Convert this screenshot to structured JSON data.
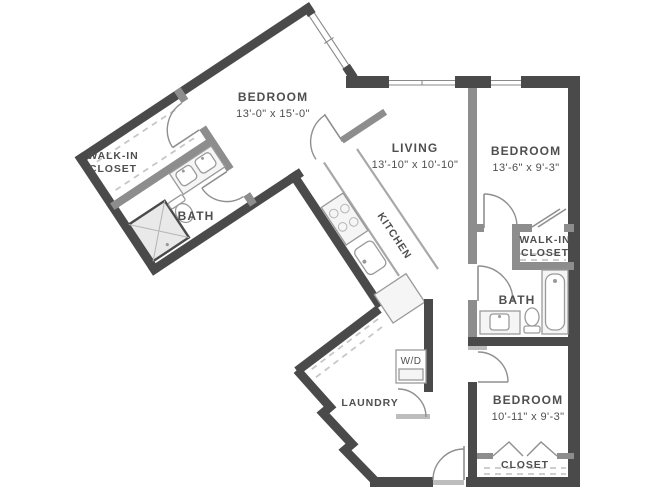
{
  "plan": {
    "rooms": {
      "bedroom1": {
        "name": "BEDROOM",
        "dims": "13'-0\" x 15'-0\""
      },
      "living": {
        "name": "LIVING",
        "dims": "13'-10\" x 10'-10\""
      },
      "bedroom2": {
        "name": "BEDROOM",
        "dims": "13'-6\" x 9'-3\""
      },
      "bedroom3": {
        "name": "BEDROOM",
        "dims": "10'-11\" x 9'-3\""
      },
      "kitchen": {
        "name": "KITCHEN"
      },
      "bath1": {
        "name": "BATH"
      },
      "bath2": {
        "name": "BATH"
      },
      "wic1": {
        "line1": "WALK-IN",
        "line2": "CLOSET"
      },
      "wic2": {
        "line1": "WALK-IN",
        "line2": "CLOSET"
      },
      "laundry": {
        "name": "LAUNDRY"
      },
      "closet3": {
        "name": "CLOSET"
      },
      "wd": {
        "name": "W/D"
      }
    },
    "fixtures": [
      "shower",
      "toilet",
      "double-vanity-sinks",
      "kitchen-stove",
      "kitchen-sink",
      "refrigerator",
      "washer-dryer",
      "bathtub",
      "vanity-sink",
      "closet-rods"
    ],
    "colors": {
      "exterior_wall": "#4a4a4a",
      "interior_wall": "#8d8d8d",
      "fixture_stroke": "#9a9a9a",
      "label_text": "#4f4f4f",
      "background": "#ffffff"
    }
  }
}
